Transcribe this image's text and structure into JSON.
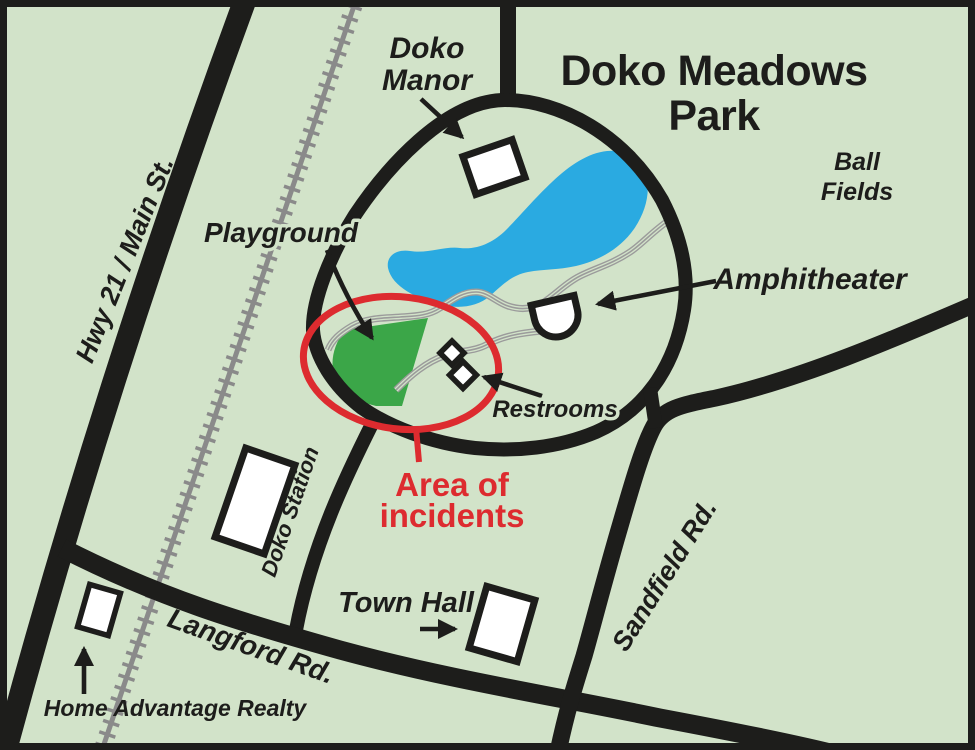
{
  "map": {
    "title": {
      "line1": "Doko Meadows",
      "line2": "Park"
    },
    "labels": {
      "hwy_21_main_st": "Hwy 21 / Main St.",
      "doko_manor_line1": "Doko",
      "doko_manor_line2": "Manor",
      "ball_fields_line1": "Ball",
      "ball_fields_line2": "Fields",
      "playground": "Playground",
      "amphitheater": "Amphitheater",
      "restrooms": "Restrooms",
      "area_of_incidents_line1": "Area of",
      "area_of_incidents_line2": "incidents",
      "doko_station": "Doko Station",
      "town_hall": "Town Hall",
      "sandfield_rd": "Sandfield Rd.",
      "langford_rd": "Langford Rd.",
      "home_advantage_realty": "Home Advantage Realty"
    },
    "colors": {
      "background": "#d2e3c9",
      "road": "#1d1d1b",
      "railroad": "#8a8a8a",
      "trail": "#9b9b9b",
      "pond": "#2aaae1",
      "playground_area": "#3ba648",
      "incident_red": "#dd2b2f",
      "building_fill": "#ffffff",
      "text": "#1d1d1b"
    }
  }
}
